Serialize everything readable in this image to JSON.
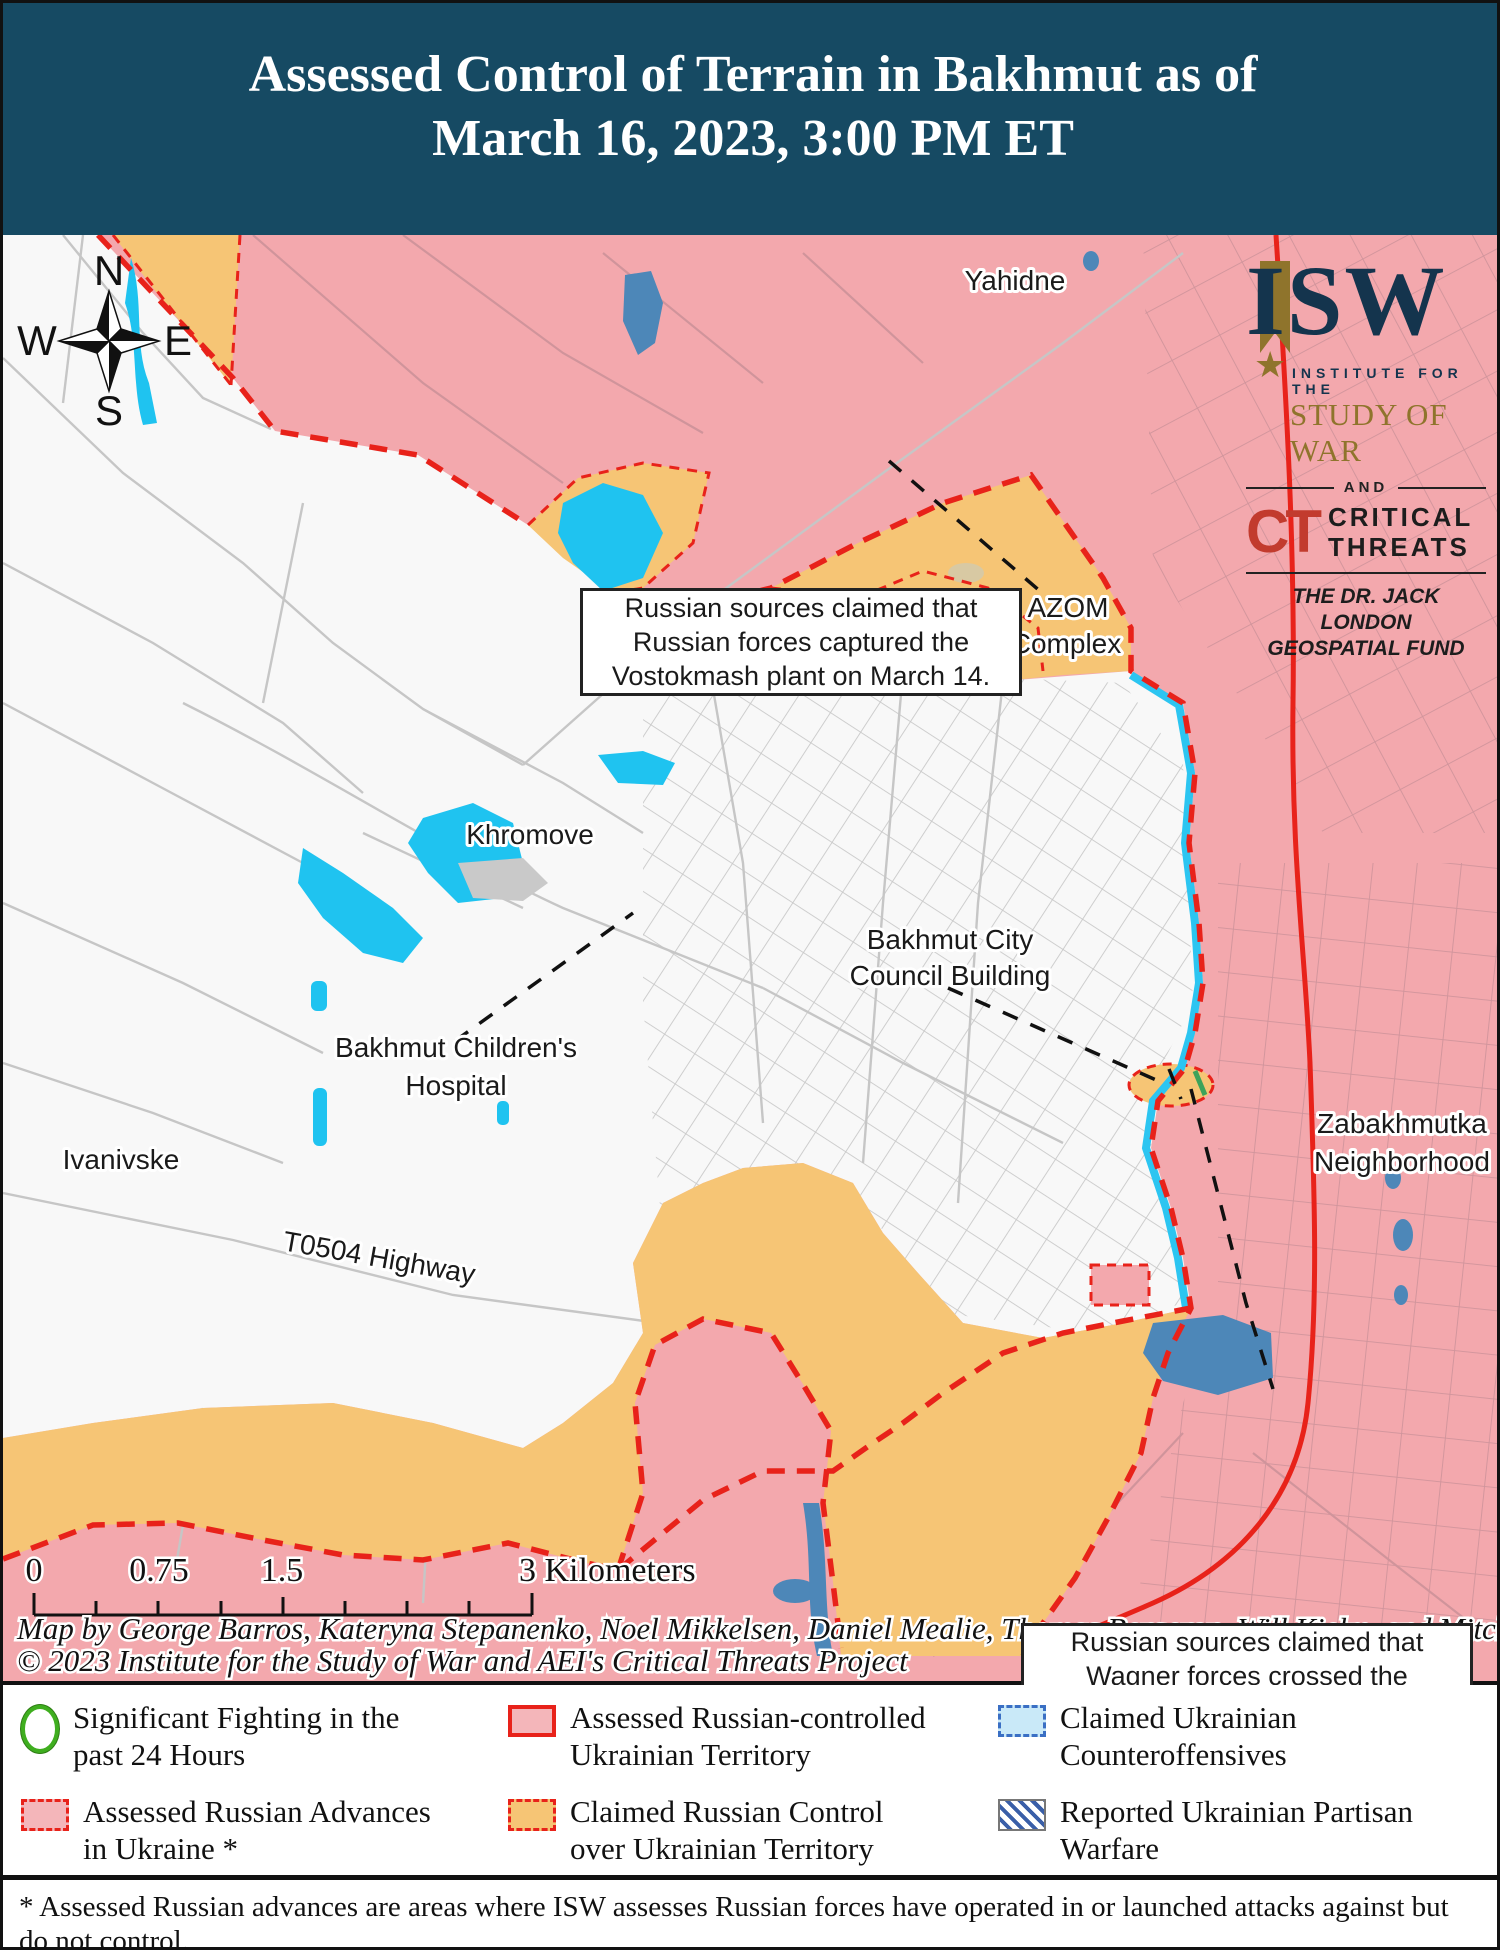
{
  "header": {
    "title_line1": "Assessed Control of Terrain in Bakhmut as of",
    "title_line2": "March 16, 2023, 3:00 PM ET"
  },
  "map": {
    "compass": {
      "n": "N",
      "e": "E",
      "s": "S",
      "w": "W"
    },
    "labels": {
      "yahidne": "Yahidne",
      "khromove": "Khromove",
      "azom_line1": "AZOM",
      "azom_line2": "Complex",
      "council_line1": "Bakhmut City",
      "council_line2": "Council Building",
      "hospital_line1": "Bakhmut Children's",
      "hospital_line2": "Hospital",
      "ivanivske": "Ivanivske",
      "highway": "T0504 Highway",
      "zabakhmutka_line1": "Zabakhmutka",
      "zabakhmutka_line2": "Neighborhood"
    },
    "annotations": {
      "vostokmash": "Russian sources claimed that Russian forces captured the Vostokmash plant on March 14.",
      "wagner": "Russian sources claimed that Wagner forces crossed the Bakhmutka River as of March 10"
    },
    "logo": {
      "isw": "ISW",
      "star": "★",
      "institute": "INSTITUTE FOR THE",
      "study": "STUDY OF WAR",
      "and": "AND",
      "ct": "CT",
      "critical": "CRITICAL",
      "threats": "THREATS",
      "fund_line1": "THE DR. JACK LONDON",
      "fund_line2": "GEOSPATIAL FUND"
    },
    "scale_bar": {
      "t0": "0",
      "t1": "0.75",
      "t2": "1.5",
      "t3": "3 Kilometers"
    },
    "attribution_line1": "Map by George Barros, Kateryna Stepanenko, Noel Mikkelsen, Daniel Mealie, Thomas Bergeron, Will Kielm, and Mitchell Belcher",
    "attribution_line2": "© 2023 Institute for the Study of War and AEI's Critical Threats Project"
  },
  "legend": {
    "items": [
      {
        "key": "significant-fighting",
        "label": "Significant Fighting in the past 24 Hours"
      },
      {
        "key": "russian-controlled",
        "label": "Assessed Russian-controlled Ukrainian Territory"
      },
      {
        "key": "ukrainian-counteroffensives",
        "label": "Claimed Ukrainian Counteroffensives"
      },
      {
        "key": "russian-advances",
        "label": "Assessed Russian Advances in Ukraine *"
      },
      {
        "key": "claimed-russian-control",
        "label": "Claimed Russian Control over Ukrainian Territory"
      },
      {
        "key": "partisan-warfare",
        "label": "Reported Ukrainian Partisan Warfare"
      }
    ]
  },
  "footnote": "* Assessed Russian advances are areas where ISW assesses Russian forces have operated in or launched attacks against but do not control.",
  "colors": {
    "header_bg": "#164a63",
    "russian_pink": "#f3a8ad",
    "claimed_orange": "#f6c575",
    "front_red": "#e8221a",
    "counteroffensive_cyan": "#2cc5f1",
    "water_cyan": "#1fc3f0",
    "water_steel": "#4d87b8",
    "isw_navy": "#14344d",
    "isw_gold": "#8f742c",
    "ct_red": "#c23b2e",
    "fighting_green": "#3fae1f"
  }
}
